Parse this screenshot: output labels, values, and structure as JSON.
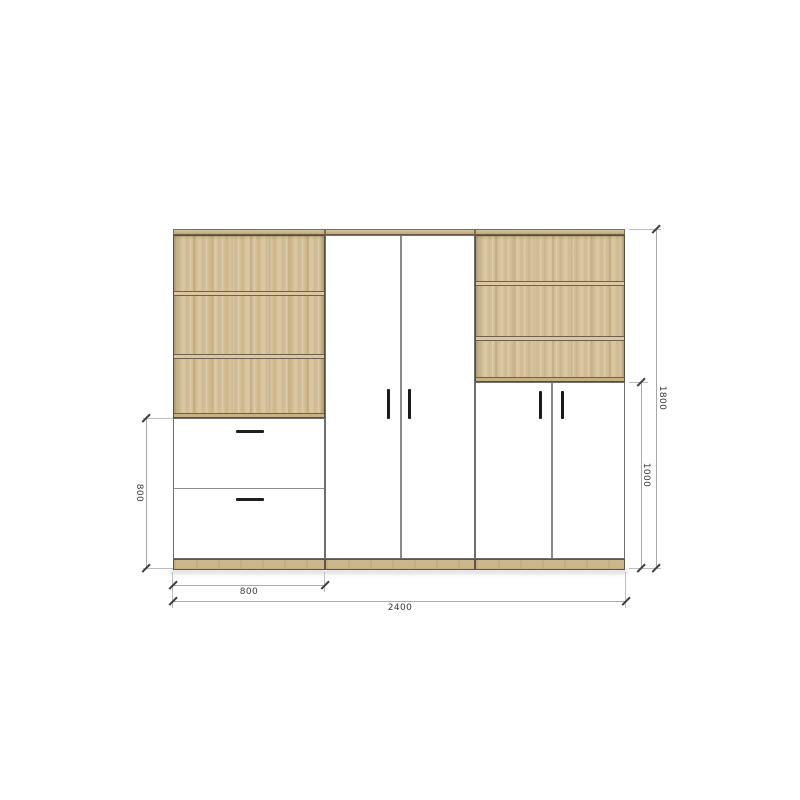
{
  "drawing": {
    "type": "furniture-elevation",
    "dimensions": {
      "total_width_mm": "2400",
      "total_height_mm": "1800",
      "left_section_width_mm": "800",
      "left_lower_height_mm": "800",
      "right_lower_height_mm": "1000"
    },
    "colors": {
      "wood": "#d5c198",
      "wood_edge": "#c8b287",
      "outline": "#57503f",
      "door_white": "#ffffff",
      "handle": "#1b1b1b",
      "dim_line": "#a9a9a9",
      "dim_text": "#3a3a3a",
      "background": "#ffffff"
    }
  }
}
